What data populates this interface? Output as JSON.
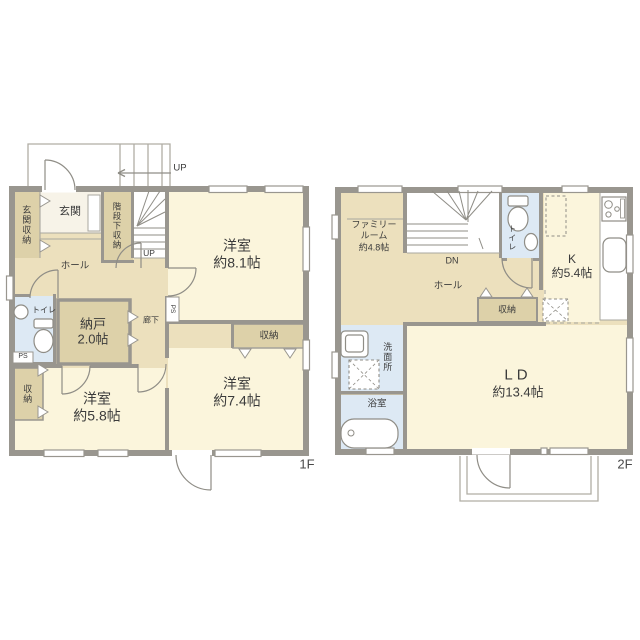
{
  "palette": {
    "wall": "#99968f",
    "thin_line": "#aaa79f",
    "room_cream": "#fbf5dc",
    "hall_tan": "#ece0bd",
    "closet_tan": "#ddd1a9",
    "wet_blue": "#dde9f4",
    "entry_white": "#f7f3e8",
    "text": "#3b3b3b"
  },
  "f1": {
    "floor_label": "1F",
    "porch_up": "UP",
    "stairs_up": "UP",
    "genkan": "玄関",
    "genkan_shuno": "玄関収納",
    "kaidan_shita_shuno": "階段下収納",
    "hall": "ホール",
    "toilet": "トイレ",
    "roka": "廊下",
    "ps_top": "PS",
    "ps_bottom": "PS",
    "shuno_left": "収納",
    "shuno_right": "収納",
    "nando": {
      "name": "納戸",
      "size": "2.0帖"
    },
    "yoshitsu81": {
      "name": "洋室",
      "size": "約8.1帖"
    },
    "yoshitsu74": {
      "name": "洋室",
      "size": "約7.4帖"
    },
    "yoshitsu58": {
      "name": "洋室",
      "size": "約5.8帖"
    }
  },
  "f2": {
    "floor_label": "2F",
    "stairs_dn": "DN",
    "toilet": "トイレ",
    "hall": "ホール",
    "shuno": "収納",
    "senmenjo": "洗面所",
    "yokushitsu": "浴室",
    "family_room": {
      "name": "ファミリールーム",
      "size": "約4.8帖"
    },
    "kitchen": {
      "name": "K",
      "size": "約5.4帖"
    },
    "ld": {
      "name": "LD",
      "size": "約13.4帖"
    }
  }
}
